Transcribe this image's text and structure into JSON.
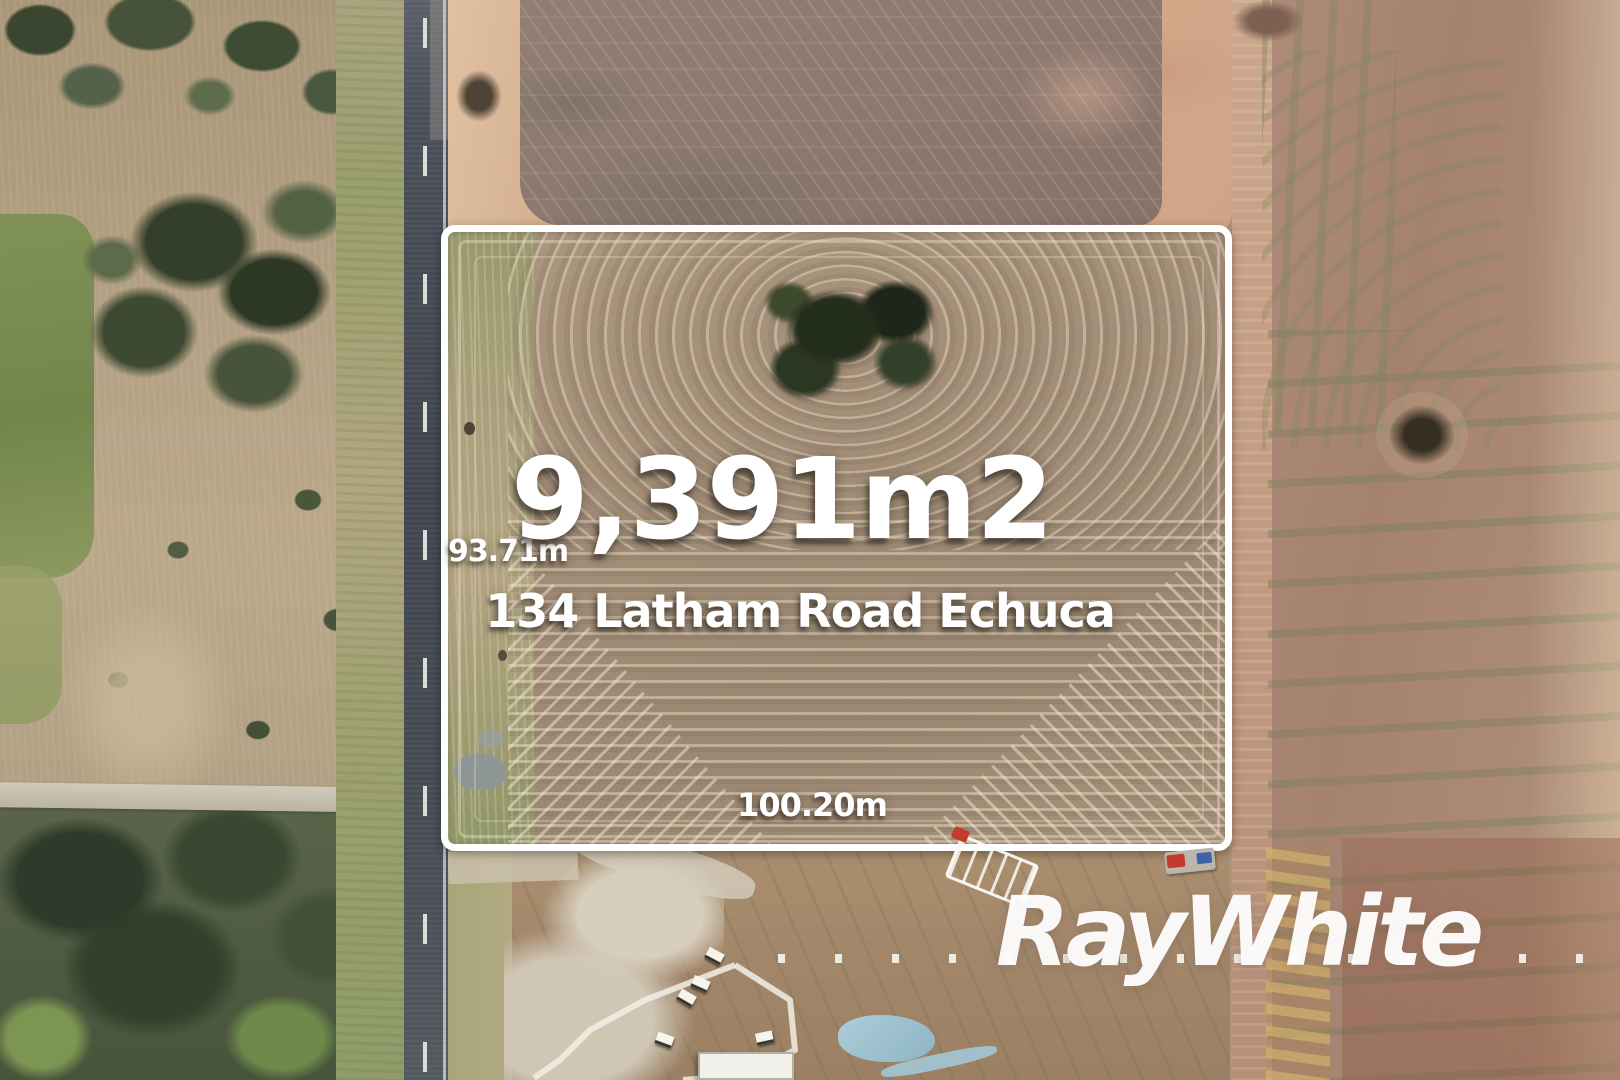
{
  "listing": {
    "area_label": "9,391m2",
    "address": "134 Latham Road Echuca",
    "west_side_length": "93.71m",
    "south_side_length": "100.20m"
  },
  "brand": {
    "watermark": "RayWhite"
  },
  "colors": {
    "boundary_outline": "#ffffff",
    "overlay_text": "#ffffff",
    "brand_watermark": "#ffffff"
  }
}
